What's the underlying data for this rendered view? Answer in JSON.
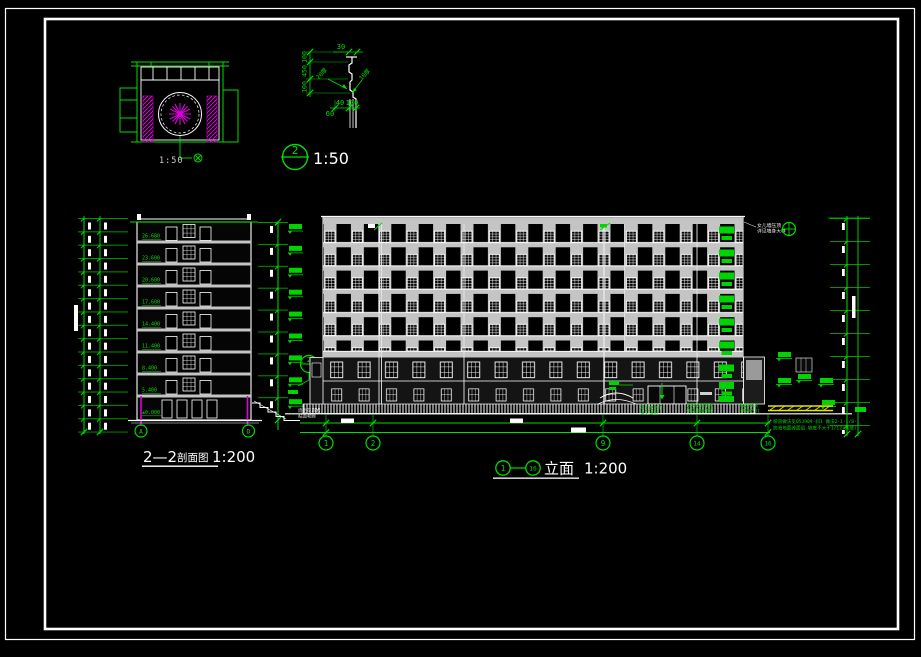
{
  "plan_detail": {
    "scale_label": "1:50"
  },
  "molding_detail": {
    "dim_top": "30",
    "dims_left": [
      "100",
      "450",
      "100"
    ],
    "dim_bottom_a": "40",
    "dim_bottom_b": "100",
    "dim_bottom_c": "60",
    "label_left": "20厚",
    "label_right": "10厚"
  },
  "callout": {
    "number": "2",
    "scale_label": "1:50"
  },
  "section": {
    "title_num": "2—2",
    "title_cn": "剖面图",
    "scale": "1:200",
    "levels": [
      "26.680",
      "23.600",
      "20.600",
      "17.600",
      "14.400",
      "11.400",
      "8.400",
      "5.400",
      "±0.000"
    ],
    "axis_a": "A",
    "axis_b": "D",
    "callout_number": "2"
  },
  "elevation": {
    "axis_from": "1",
    "axis_to": "16",
    "title": "立面",
    "scale": "1:200",
    "grid_bubbles": [
      "1",
      "2",
      "9",
      "14",
      "16"
    ],
    "top_right_note_1": "女儿墙压顶",
    "top_right_note_2": "详见墙身大样",
    "left_base_note_1": "烧毛花岗岩",
    "left_base_note_2": "贴面勒脚",
    "base_note_a1": "花岗岩台阶",
    "base_note_a2": "详见详图",
    "base_note_b1": "水泥砂浆坡道",
    "base_note_b2": "详见建施详图",
    "base_note_c1": "散水做法",
    "base_note_c2": "详见05J1",
    "ramp_note_1": "坡道做法见05J909-斜1 做法2-1-1/8-1",
    "ramp_note_2": "防滑地面砖面层 坡度不大于1/12(残坡)"
  }
}
